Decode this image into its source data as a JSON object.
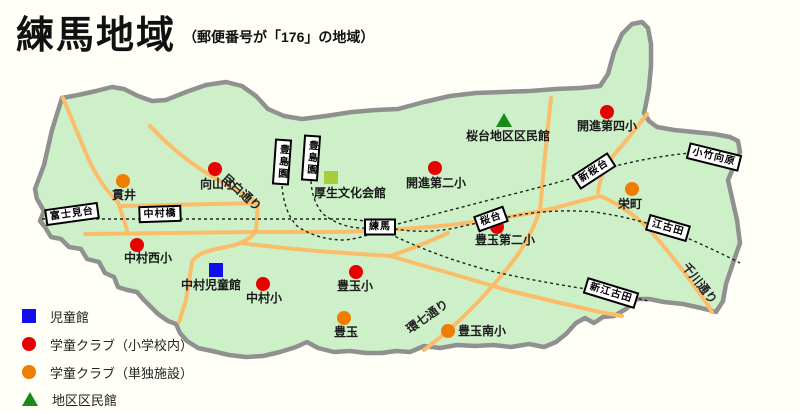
{
  "title": "練馬地域",
  "subtitle": "（郵便番号が「176」の地域）",
  "legend": {
    "items": [
      {
        "marker": "blue-square",
        "label": "児童館"
      },
      {
        "marker": "red-circle",
        "label": "学童クラブ（小学校内）"
      },
      {
        "marker": "orange-circle",
        "label": "学童クラブ（単独施設）"
      },
      {
        "marker": "green-triangle",
        "label": "地区区民館"
      }
    ]
  },
  "facilities": [
    {
      "label": "貫井",
      "type": "gakudo-standalone"
    },
    {
      "label": "向山小",
      "type": "gakudo-school"
    },
    {
      "label": "中村西小",
      "type": "gakudo-school"
    },
    {
      "label": "中村児童館",
      "type": "jidokan"
    },
    {
      "label": "中村小",
      "type": "gakudo-school"
    },
    {
      "label": "豊玉小",
      "type": "gakudo-school"
    },
    {
      "label": "豊玉",
      "type": "gakudo-standalone"
    },
    {
      "label": "豊玉南小",
      "type": "gakudo-standalone"
    },
    {
      "label": "豊玉第二小",
      "type": "gakudo-school"
    },
    {
      "label": "開進第二小",
      "type": "gakudo-school"
    },
    {
      "label": "開進第四小",
      "type": "gakudo-school"
    },
    {
      "label": "栄町",
      "type": "gakudo-standalone"
    },
    {
      "label": "桜台地区区民館",
      "type": "kuminkan"
    },
    {
      "label": "厚生文化会館",
      "type": "hall"
    }
  ],
  "stations": [
    {
      "name": "富士見台"
    },
    {
      "name": "中村橋"
    },
    {
      "name": "練馬"
    },
    {
      "name": "桜台"
    },
    {
      "name": "豊島園"
    },
    {
      "name": "豊島園"
    },
    {
      "name": "新桜台"
    },
    {
      "name": "小竹向原"
    },
    {
      "name": "江古田"
    },
    {
      "name": "新江古田"
    }
  ],
  "roads": [
    {
      "name": "目白通り"
    },
    {
      "name": "環七通り"
    },
    {
      "name": "千川通り"
    }
  ],
  "colors": {
    "map_fill": "#cdf0c8",
    "boundary": "#909090",
    "road": "#fbbd69",
    "railway": "#222222",
    "jidokan_blue": "#1010ee",
    "gakudo_red": "#e60000",
    "gakudo_orange": "#ef7d00",
    "kuminkan_green": "#178a17",
    "hall_yellowgreen": "#a5ce39"
  }
}
